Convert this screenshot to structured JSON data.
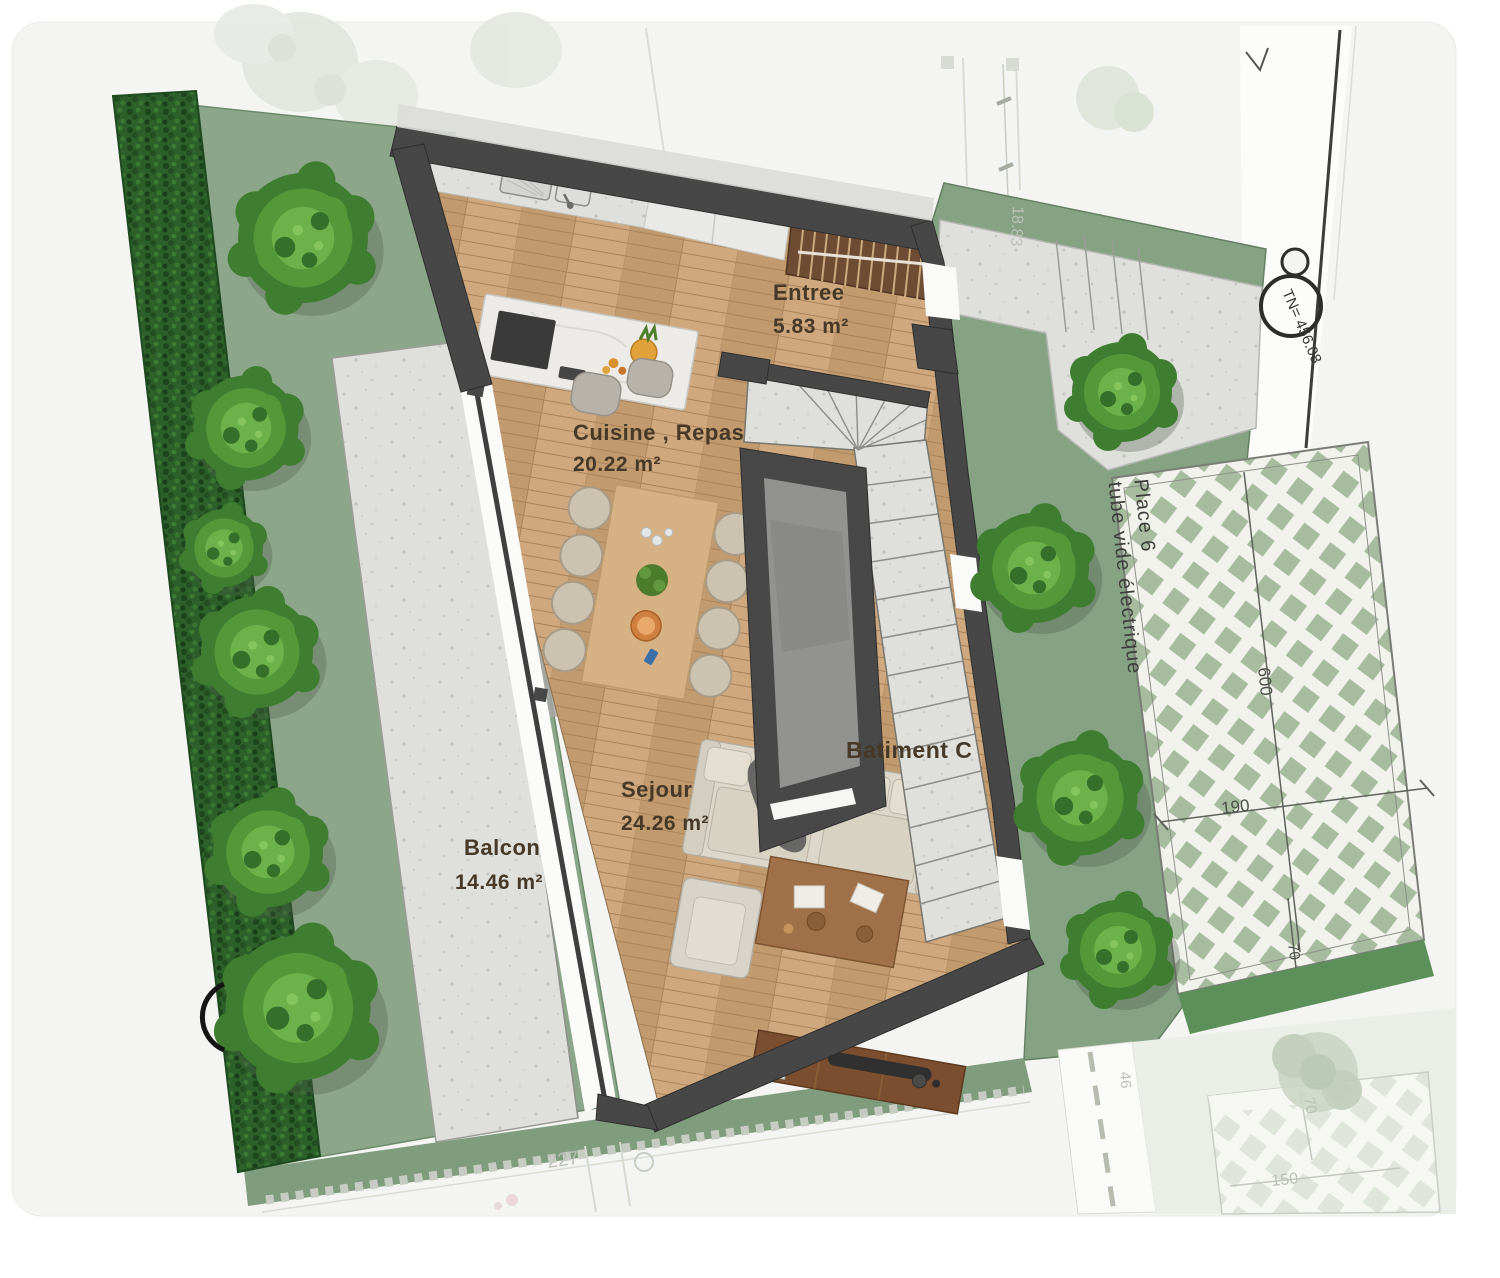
{
  "plan": {
    "rooms": [
      {
        "name": "Entree",
        "area": "5.83 m²"
      },
      {
        "name": "Cuisine , Repas",
        "area": "20.22 m²"
      },
      {
        "name": "Sejour",
        "area": "24.26 m²"
      },
      {
        "name": "Balcon",
        "area": "14.46 m²"
      }
    ],
    "building_label": "Batiment C",
    "parking": {
      "line1": "Place 6",
      "line2": "tube vide électrique",
      "dims": {
        "length": "600",
        "width": "190",
        "edge": "70"
      }
    },
    "survey": {
      "elevation": "TN= 456.08"
    },
    "site": {
      "bottom_dim": "227",
      "top_dim": "18.83",
      "road_dim": "46",
      "faint_parking": {
        "width": "150",
        "edge": "70"
      }
    },
    "palette": {
      "wall": "#474747",
      "floor_wood": "#c9a277",
      "lawn": "#8ca68a",
      "hedge": "#2c5f2a",
      "stone": "#dfe0dc",
      "parking_diamond": "#a7bb9e",
      "label_text": "#463928"
    }
  }
}
